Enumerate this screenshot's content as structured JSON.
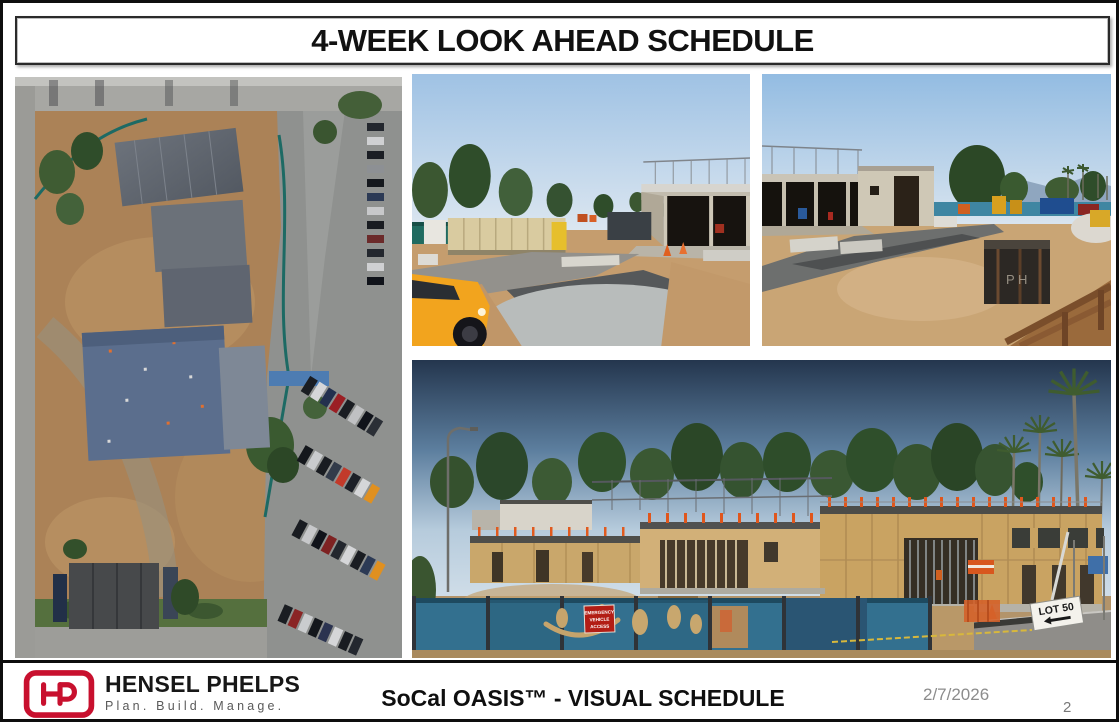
{
  "slide": {
    "title": "4-WEEK LOOK AHEAD SCHEDULE",
    "date": "2/7/2026",
    "page_number": "2"
  },
  "photos": {
    "aerial": "aerial-drone-view-of-site",
    "road": "site-access-road-with-gravel-and-truck",
    "building": "concrete-building-and-laydown-yard",
    "framing": "wood-framing-panorama-behind-site-fence"
  },
  "signs": {
    "emergency_lines": [
      "EMERGENCY",
      "VEHICLE",
      "ACCESS"
    ],
    "lot_label": "LOT 50"
  },
  "footer": {
    "logo_monogram": "HP",
    "company": "HENSEL PHELPS",
    "tagline": "Plan. Build. Manage.",
    "subtitle": "SoCal OASIS™ - VISUAL SCHEDULE"
  },
  "colors": {
    "brand_red": "#C8102E",
    "title_text": "#111111",
    "muted_gray": "#8c8c8c",
    "fence_teal": "#33708f",
    "plywood_tan": "#c9a362"
  }
}
